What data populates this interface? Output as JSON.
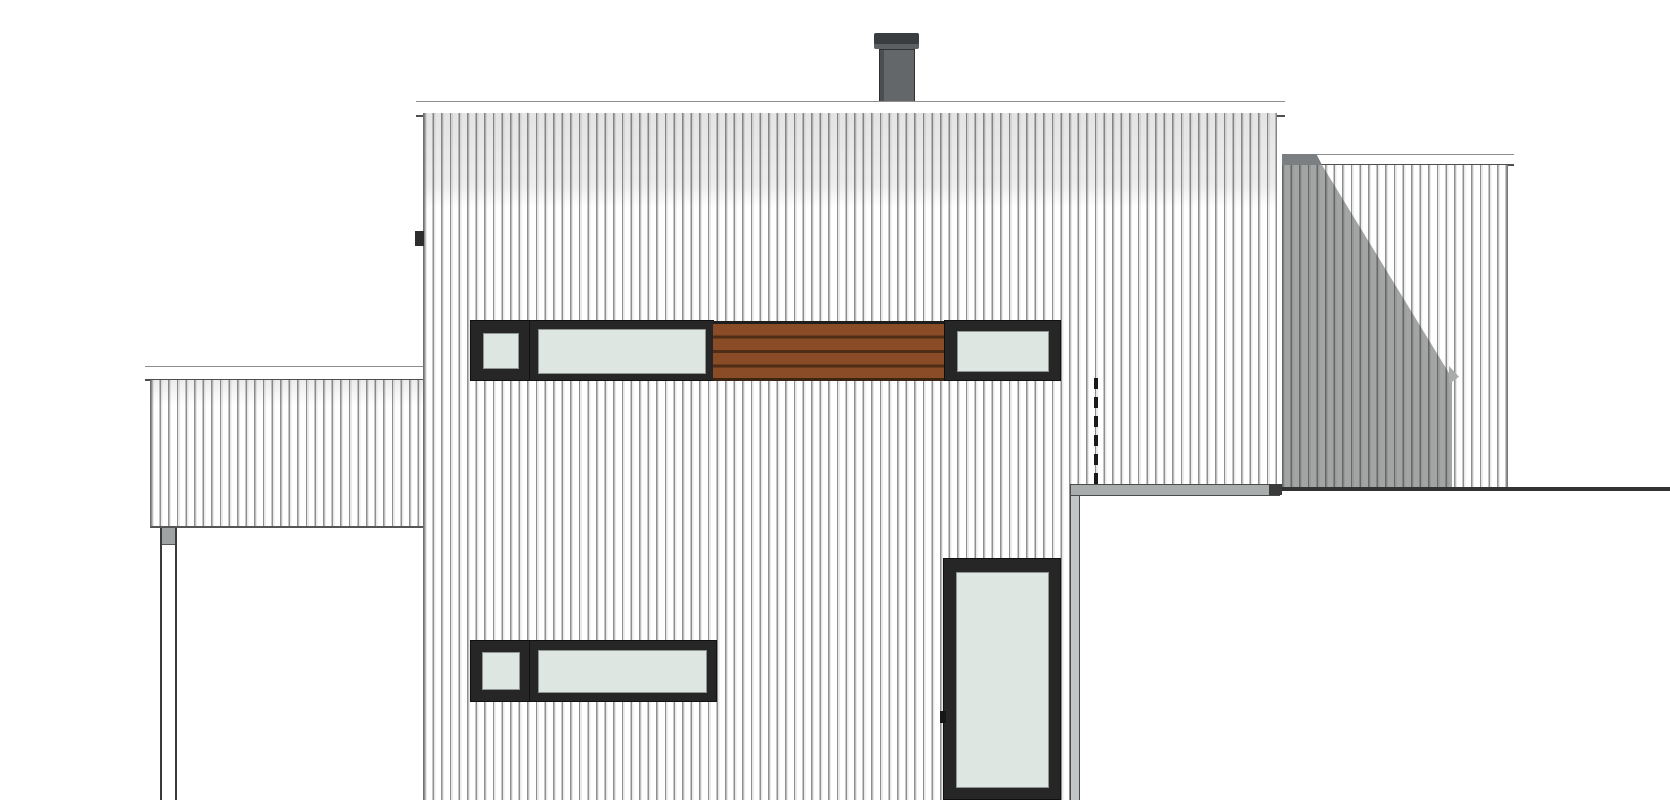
{
  "scene": {
    "title": "house-side-elevation-drawing",
    "type": "architectural-elevation",
    "background": "#ffffff"
  },
  "colors": {
    "background": "#ffffff",
    "siding_bg": "#fbfbfb",
    "siding_line": "#8f8f8f",
    "fascia_white": "#ffffff",
    "outline_dark": "#4f4f4f",
    "window_frame": "#262626",
    "glass": "#dee6e2",
    "glass_edge": "#8e9492",
    "wood": "#8a4c27",
    "wood_groove": "#4f2c15",
    "chimney_body": "#63676a",
    "chimney_cap": "#3a3d3f",
    "shadow_overlay": "rgba(52,56,56,0.45)",
    "parapet_gray": "#a9adad",
    "post_cap_gray": "#9fa3a3",
    "edge_band_gray": "#c2c6c6",
    "dark_line": "#333333",
    "dashed_line": "#1a1a1a"
  },
  "elements": {
    "chimney": "dark flue stack on main roof",
    "main_roof_fascia": "white fascia board along main roof edge",
    "main_wall": "two-storey facade with vertical corrugated cladding",
    "upper_window_band": "ribbon of square window, long window, wood slat panel, right window",
    "wood_slat_panel": "horizontal brown timber slats between upper windows",
    "lower_window_band": "square window and long window at ground floor",
    "glazed_door": "tall full-height glazed door",
    "door_handle": "small handle mark on door frame",
    "vent_dashed_line": "hidden downpipe shown dashed",
    "left_annex": "low clad side volume with fascia",
    "support_post": "slender carport post below left annex",
    "right_wing": "set-back clad volume on right side",
    "right_wing_shadow": "diagonal cast shadow on right wing",
    "foreground_roof": "white flat roof of lower building in foreground with gray parapet edge"
  }
}
